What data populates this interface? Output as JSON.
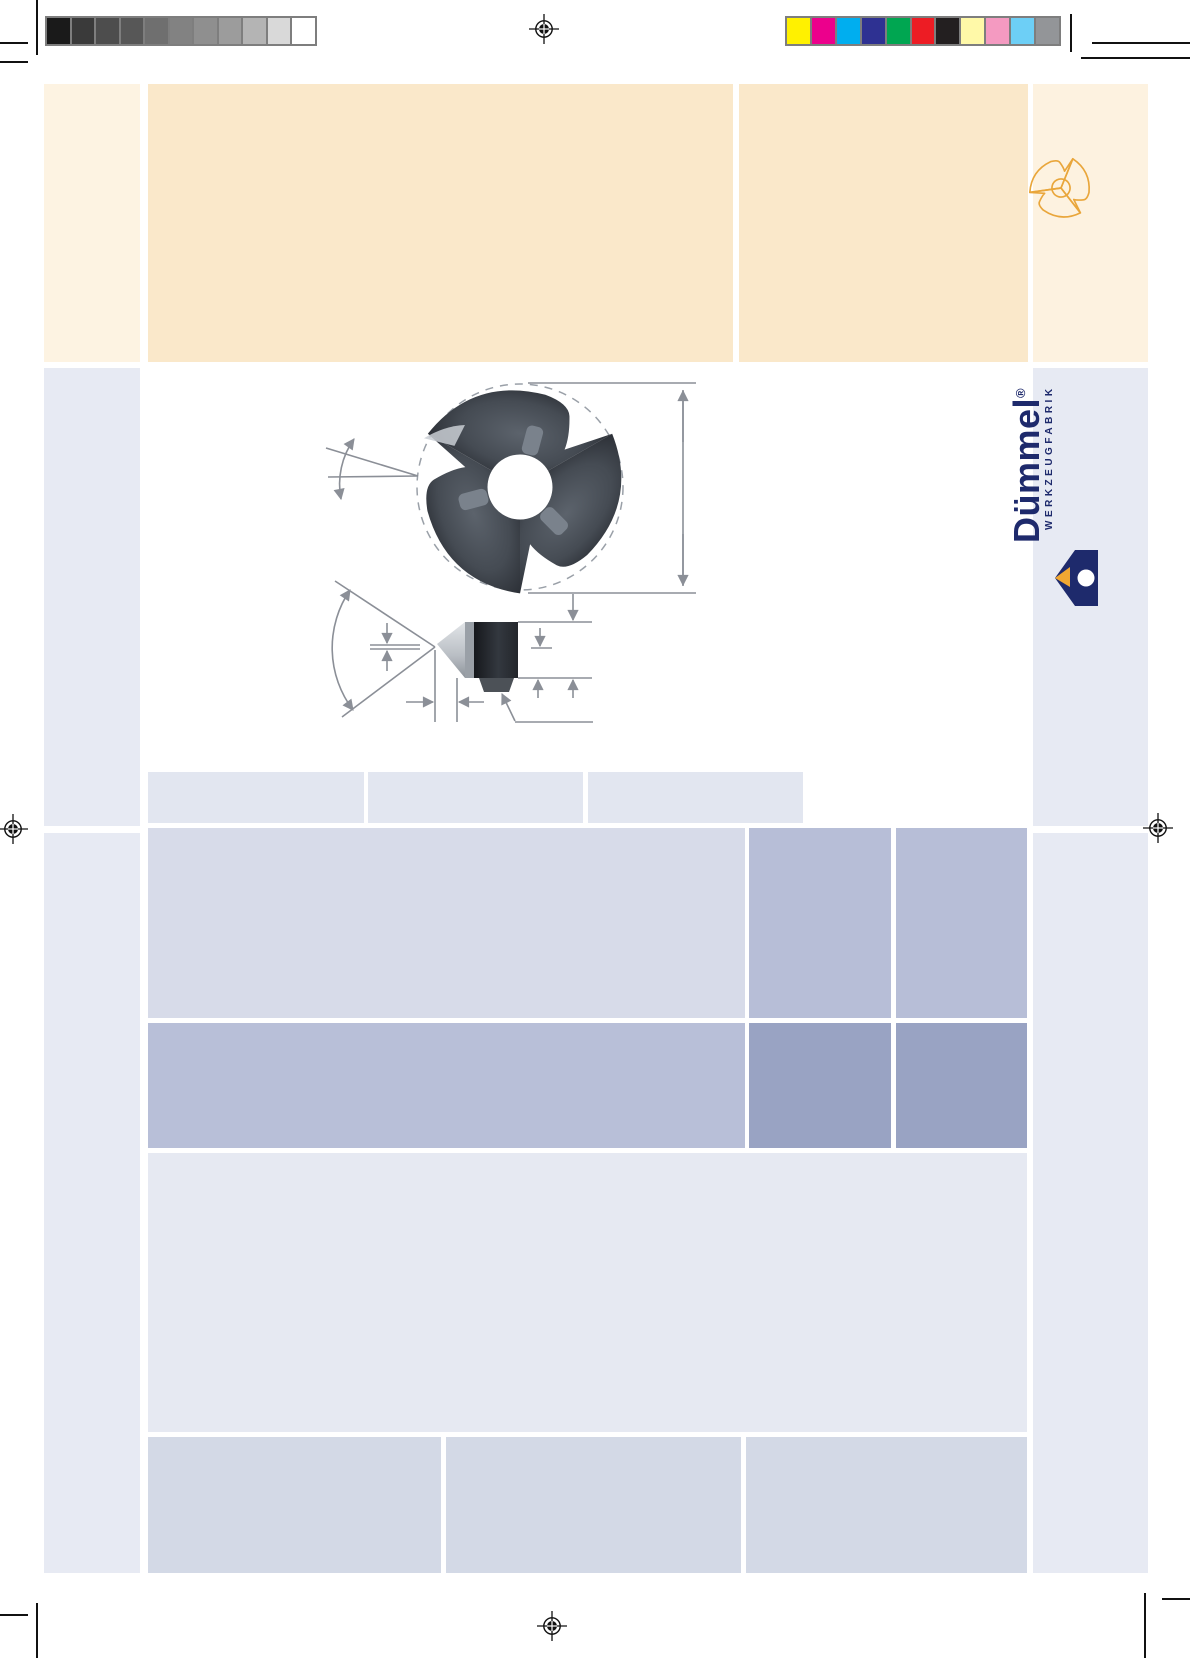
{
  "brand": {
    "name": "Dümmel",
    "registered": "®",
    "subtitle": "WERKZEUGFABRIK",
    "navy": "#1e2a6c",
    "orange": "#f0a732"
  },
  "print_calibration": {
    "grayscale": [
      "#1a1a1a",
      "#3a3a3a",
      "#4d4d4d",
      "#575757",
      "#6f6f6f",
      "#828282",
      "#8f8f8f",
      "#9c9c9c",
      "#b4b4b4",
      "#d9d9d9",
      "#ffffff"
    ],
    "colors": [
      "#fff100",
      "#ec008c",
      "#00aeef",
      "#2e3192",
      "#00a651",
      "#ed1c24",
      "#231f20",
      "#fff9a8",
      "#f49ac1",
      "#6dcff6",
      "#939598"
    ]
  },
  "palette": {
    "cream": "#fdf3e2",
    "beige": "#fae8ca",
    "lavender": "#e7eaf3",
    "tab_block": "#e2e6f0",
    "table_row1": "#d7dbe9",
    "table_cell_medium": "#b7bed7",
    "table_cell_dark": "#99a3c3",
    "bottom_block": "#d3d9e6",
    "dimension_line_gray": "#8b8f97",
    "insert_metal_dark": "#2b2f36"
  },
  "icons": {
    "header_icon": "trilobe-insert-outline-icon",
    "logomark": "duemmel-logomark-icon",
    "registration": "registration-mark-icon"
  },
  "drawing": {
    "views": [
      "insert-top-view-photo",
      "insert-side-profile-photo"
    ]
  }
}
